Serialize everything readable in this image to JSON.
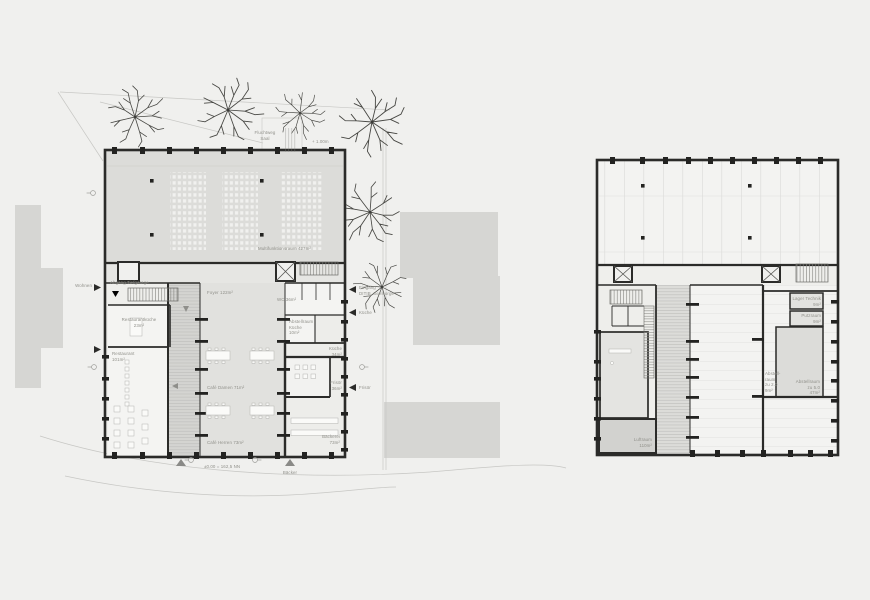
{
  "drawing": {
    "title": "floor-plans",
    "colors": {
      "background": "#f0f0ee",
      "wall": "#2b2b29",
      "hall_fill": "#dcdcd9",
      "room_fill": "#f4f4f2",
      "context_fill": "#d6d6d3",
      "label_text": "#90908a"
    }
  },
  "left_plan": {
    "top": {
      "fluchtweg": "Fluchtweg\nSaal",
      "level": "+ 1.00m"
    },
    "hall": {
      "name": "Multifunktionsraum 427m²"
    },
    "rooms": {
      "abgang": "Abgang Tiefgarage",
      "restaurantkueche": "Restaurantküche\n23m²",
      "restaurant": "Restaurant\n101m²",
      "foyer": "Foyer 122m²",
      "wc": "WC 36m²",
      "abstellraum_kueche": "Abstellraum\nKüche\n10m²",
      "kueche": "Küche\n34m²",
      "frisoer": "Frisör\n36m²",
      "cafe_damen": "Café Damen 71m²",
      "cafe_herren": "Café Herren 73m²",
      "baeckerei": "Bäckerei\n73m²"
    },
    "arrows": {
      "wohnen": "Wohnen",
      "eingang_ditib": "Eingang\nDITIB, Seelsorge",
      "kueche": "Küche",
      "frisoer": "Frisör"
    },
    "bottom": {
      "level": "±0.00 = 162,5 NN",
      "baecker": "Bäcker"
    }
  },
  "right_plan": {
    "rooms": {
      "lager_technik": "Lager Technik\n9m²",
      "putzraum": "Putzraum\n9m²",
      "abstellraum_20": "Abstell-\nraum\nzu 2.0\n9m²",
      "abstellraum_50": "Abstellraum\nzu 5.0\n47m²",
      "luftraum": "Luftraum\n110m²"
    }
  }
}
